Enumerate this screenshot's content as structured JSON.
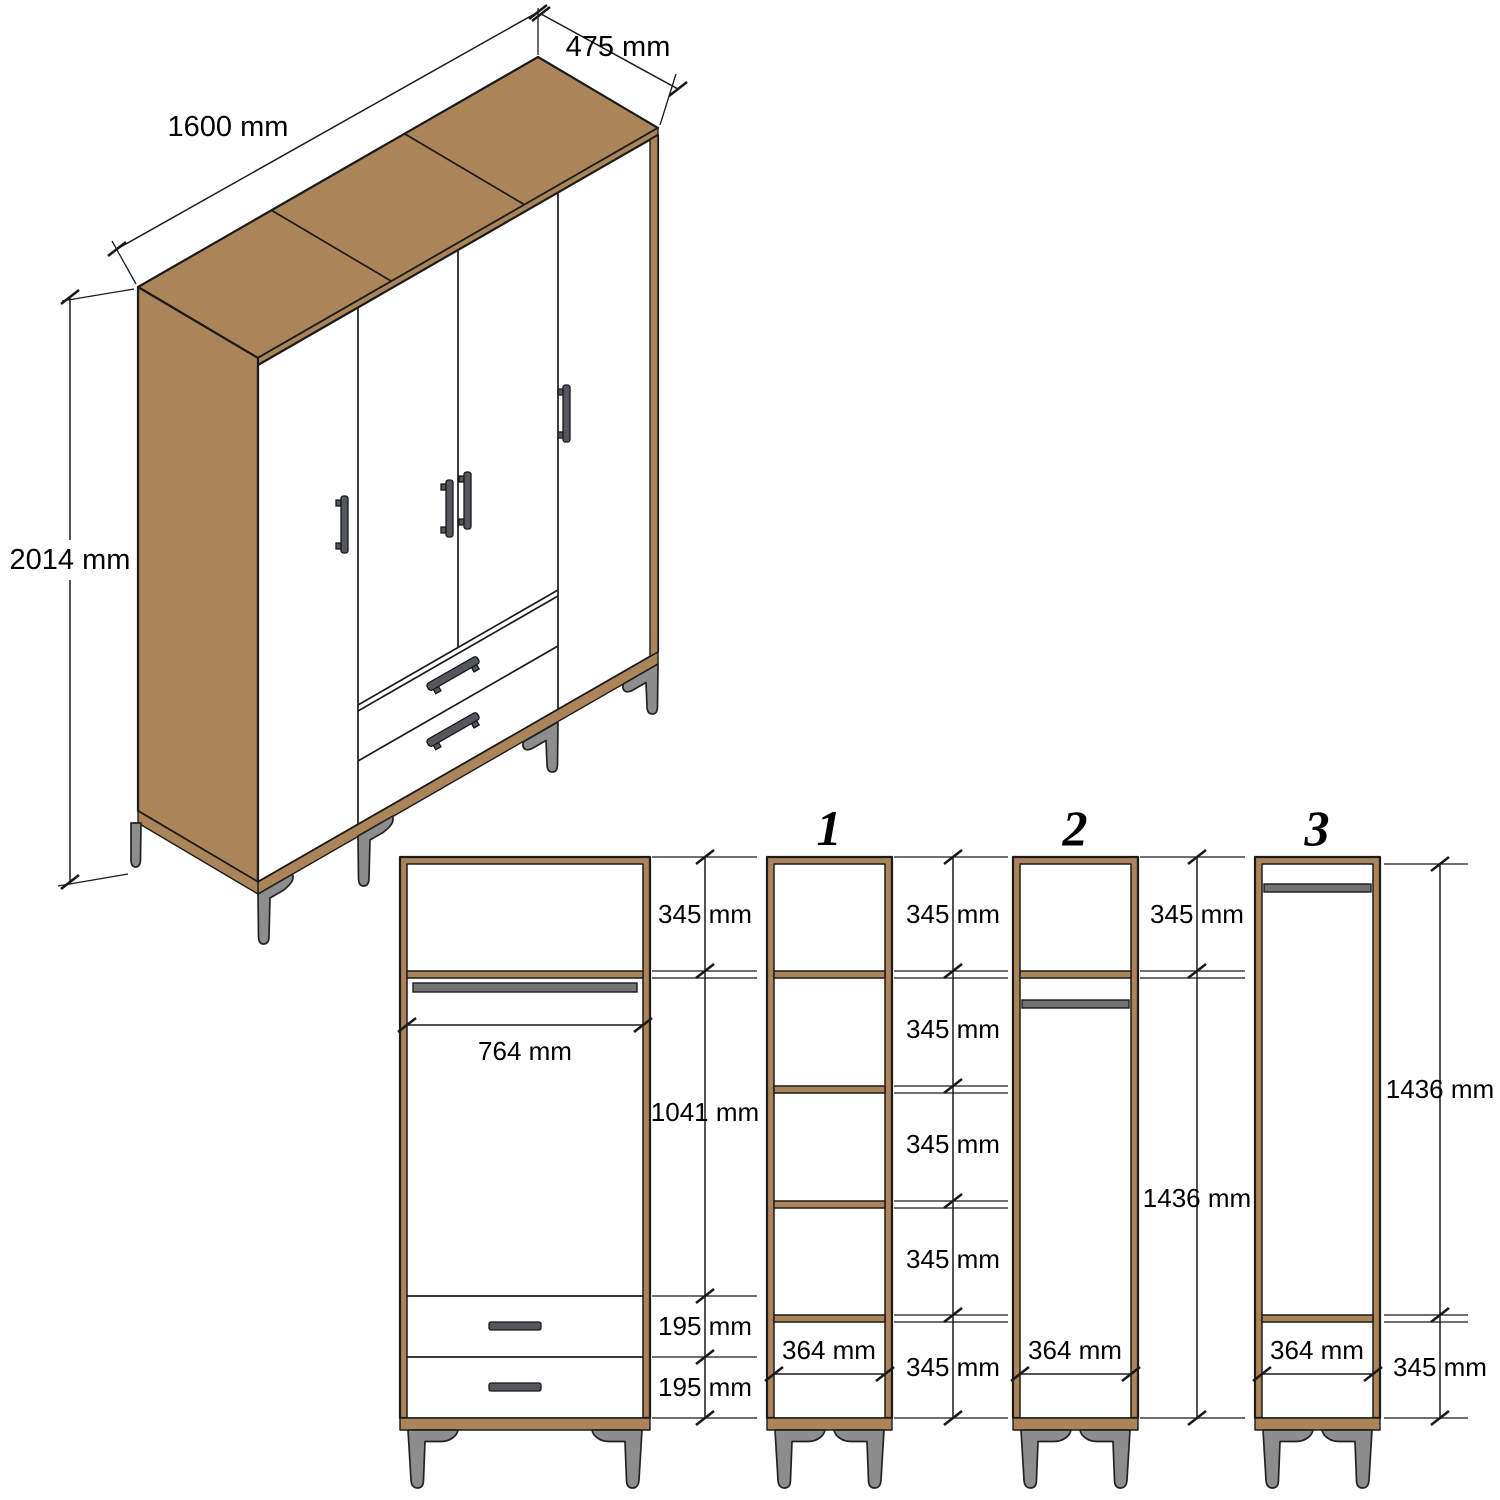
{
  "drawing": {
    "type": "furniture-assembly-dimension-diagram",
    "subject": "four-door wardrobe with two drawers",
    "units": "mm",
    "colors": {
      "wood": "#ac8459",
      "outline": "#1b1b1b",
      "metal_feet": "#8d8d8d",
      "hanging_rail": "#737373",
      "handle": "#54585e",
      "background": "#ffffff"
    },
    "isometric_view": {
      "width_label": "1600 mm",
      "depth_label": "475 mm",
      "height_label": "2014 mm"
    },
    "front_section_view": {
      "right_dimensions": [
        "345 mm",
        "1041 mm",
        "195 mm",
        "195 mm"
      ],
      "inner_width_label": "764 mm"
    },
    "column_views": [
      {
        "number": "1",
        "right_dimensions": [
          "345 mm",
          "345 mm",
          "345 mm",
          "345 mm",
          "345 mm"
        ],
        "inner_width_label": "364 mm"
      },
      {
        "number": "2",
        "right_dimensions": [
          "345 mm",
          "1436 mm"
        ],
        "inner_width_label": "364 mm"
      },
      {
        "number": "3",
        "right_dimensions": [
          "1436 mm",
          "345 mm"
        ],
        "inner_width_label": "364 mm"
      }
    ]
  }
}
